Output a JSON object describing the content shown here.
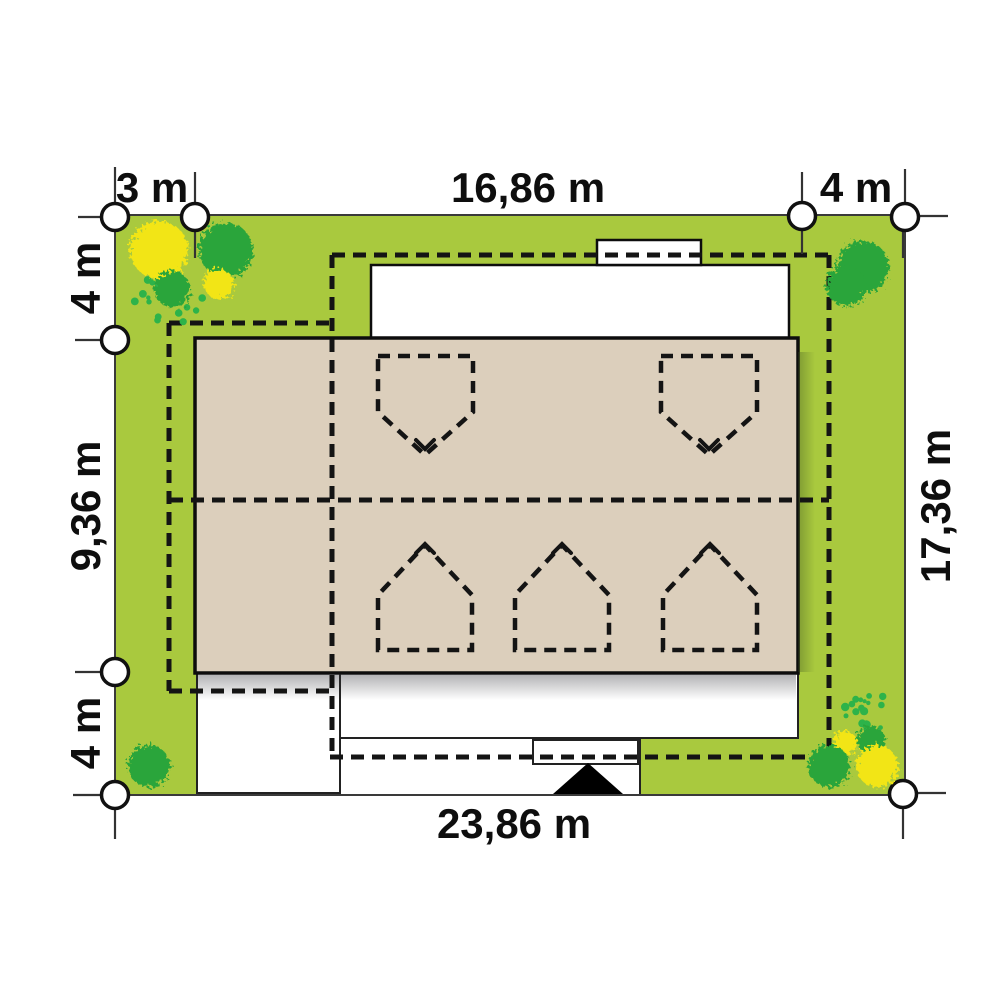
{
  "plan": {
    "type": "site-plan",
    "dimensions": {
      "top": [
        {
          "label": "3 m"
        },
        {
          "label": "16,86 m"
        },
        {
          "label": "4 m"
        }
      ],
      "left": [
        {
          "label": "4 m"
        },
        {
          "label": "9,36 m"
        },
        {
          "label": "4 m"
        }
      ],
      "right": [
        {
          "label": "17,36 m"
        }
      ],
      "bottom": [
        {
          "label": "23,86 m"
        }
      ]
    },
    "colors": {
      "lawn": "#a9c93e",
      "lawn_border": "#3a3a3a",
      "roof": "#dccfbc",
      "outline": "#0d0d0d",
      "dashed_line": "#141414",
      "tree_green": "#29a53b",
      "tree_yellow": "#f2e513",
      "shrub_green": "#2db34a",
      "paving_white": "#ffffff"
    },
    "survey_markers": [
      {
        "cx": 115,
        "cy": 217
      },
      {
        "cx": 195,
        "cy": 217
      },
      {
        "cx": 802,
        "cy": 216
      },
      {
        "cx": 905,
        "cy": 217
      },
      {
        "cx": 115,
        "cy": 340
      },
      {
        "cx": 115,
        "cy": 672
      },
      {
        "cx": 115,
        "cy": 795
      },
      {
        "cx": 903,
        "cy": 794
      }
    ],
    "extension_ticks": [
      {
        "x1": 115,
        "y1": 167,
        "x2": 115,
        "y2": 202
      },
      {
        "x1": 195,
        "y1": 172,
        "x2": 195,
        "y2": 202
      },
      {
        "x1": 802,
        "y1": 172,
        "x2": 802,
        "y2": 201
      },
      {
        "x1": 905,
        "y1": 169,
        "x2": 905,
        "y2": 202
      },
      {
        "x1": 195,
        "y1": 232,
        "x2": 195,
        "y2": 258
      },
      {
        "x1": 802,
        "y1": 231,
        "x2": 802,
        "y2": 254
      },
      {
        "x1": 903,
        "y1": 232,
        "x2": 903,
        "y2": 258
      },
      {
        "x1": 78,
        "y1": 217,
        "x2": 101,
        "y2": 217
      },
      {
        "x1": 75,
        "y1": 340,
        "x2": 101,
        "y2": 340
      },
      {
        "x1": 75,
        "y1": 672,
        "x2": 101,
        "y2": 672
      },
      {
        "x1": 73,
        "y1": 795,
        "x2": 101,
        "y2": 795
      },
      {
        "x1": 920,
        "y1": 216,
        "x2": 948,
        "y2": 216
      },
      {
        "x1": 917,
        "y1": 793,
        "x2": 946,
        "y2": 793
      },
      {
        "x1": 115,
        "y1": 810,
        "x2": 115,
        "y2": 839
      },
      {
        "x1": 903,
        "y1": 809,
        "x2": 903,
        "y2": 839
      }
    ],
    "trees": [
      {
        "cx": 159,
        "cy": 250,
        "r": 29,
        "kind": "yellow"
      },
      {
        "cx": 226,
        "cy": 250,
        "r": 27,
        "kind": "green"
      },
      {
        "cx": 172,
        "cy": 289,
        "r": 18,
        "kind": "green"
      },
      {
        "cx": 219,
        "cy": 284,
        "r": 15,
        "kind": "yellow"
      },
      {
        "cx": 863,
        "cy": 267,
        "r": 26,
        "kind": "green"
      },
      {
        "cx": 846,
        "cy": 286,
        "r": 20,
        "kind": "green"
      },
      {
        "cx": 149,
        "cy": 766,
        "r": 21,
        "kind": "green"
      },
      {
        "cx": 845,
        "cy": 743,
        "r": 12,
        "kind": "yellow"
      },
      {
        "cx": 871,
        "cy": 740,
        "r": 14,
        "kind": "green"
      },
      {
        "cx": 877,
        "cy": 766,
        "r": 21,
        "kind": "yellow"
      },
      {
        "cx": 829,
        "cy": 766,
        "r": 21,
        "kind": "green"
      }
    ],
    "shrub_clusters": [
      {
        "cx": 165,
        "cy": 301,
        "rx": 40,
        "ry": 24,
        "count": 26,
        "seed": 3
      },
      {
        "cx": 872,
        "cy": 711,
        "rx": 29,
        "ry": 19,
        "count": 18,
        "seed": 9
      }
    ]
  }
}
